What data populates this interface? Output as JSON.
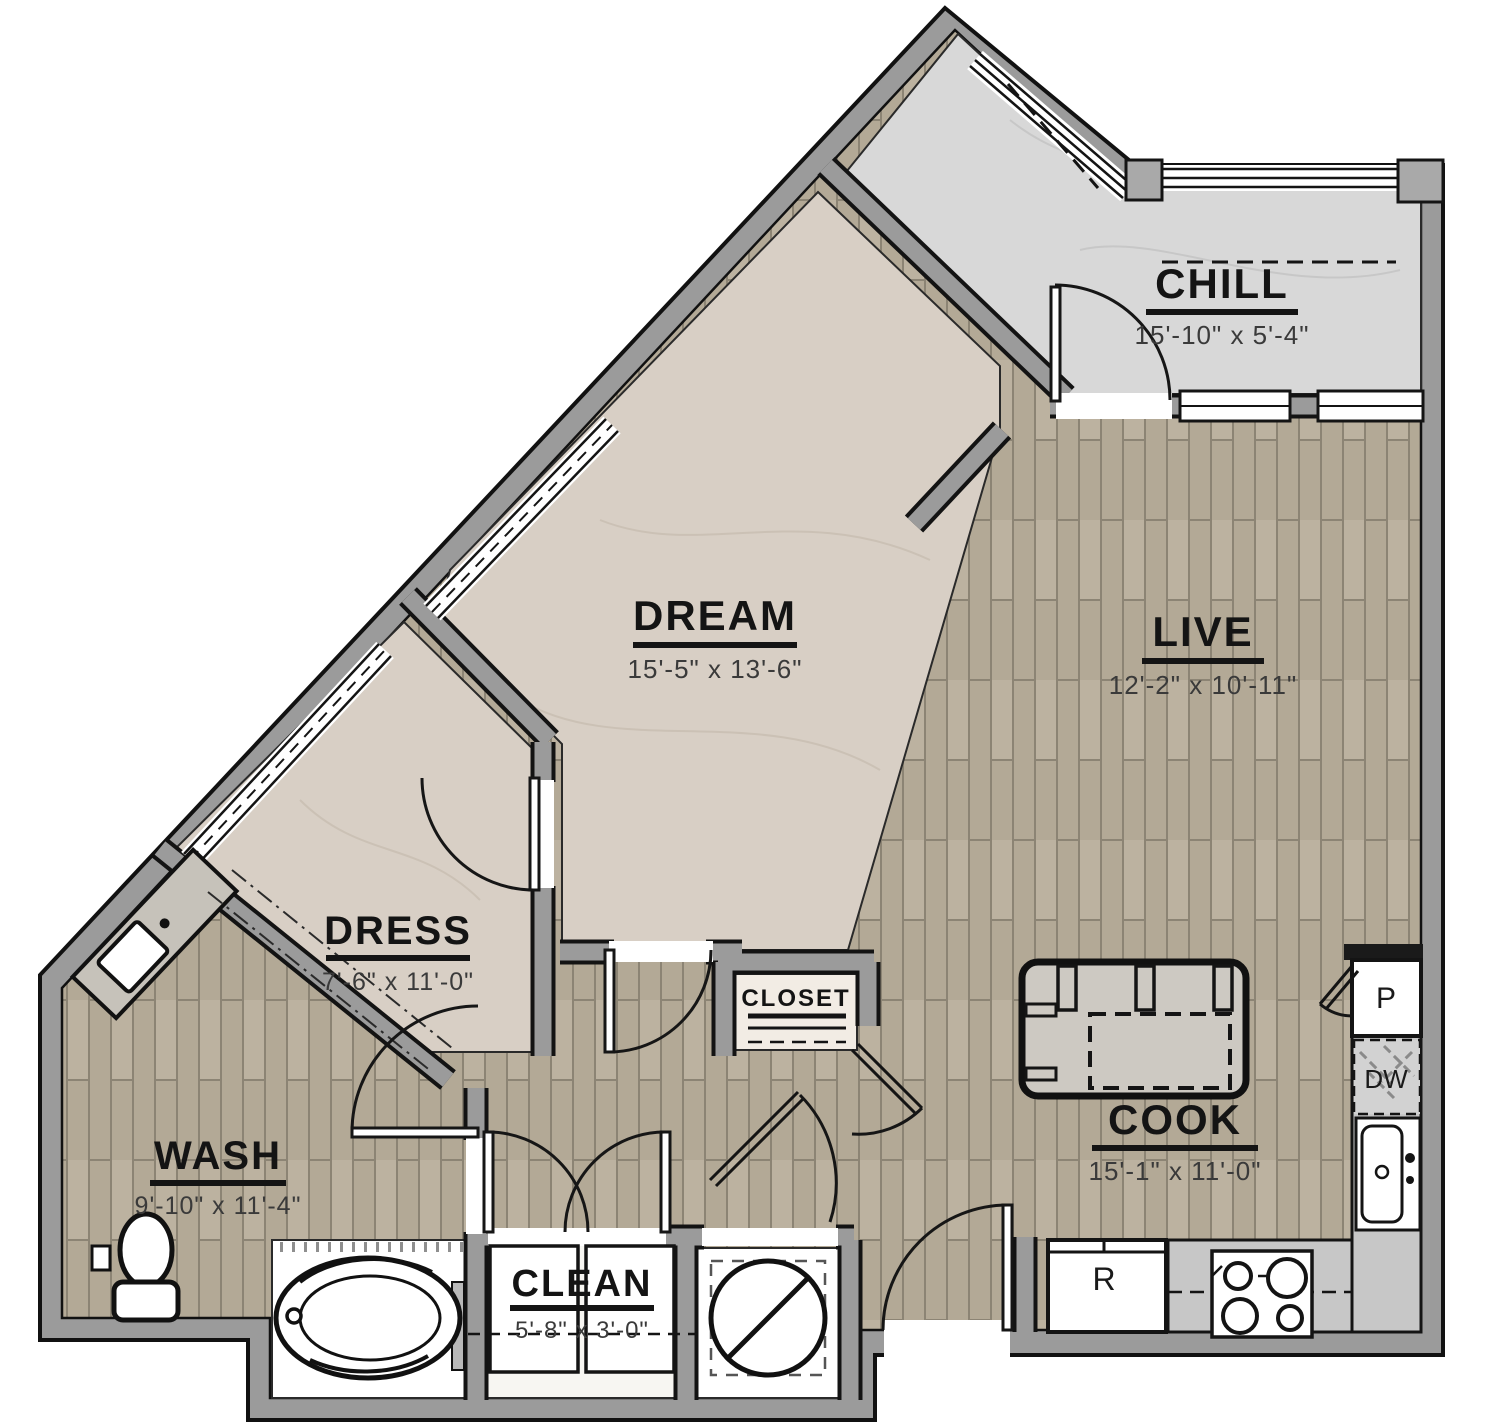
{
  "plan": {
    "type": "apartment-floor-plan",
    "rooms": [
      {
        "label": "CHILL",
        "dims": "15'-10\" x 5'-4\""
      },
      {
        "label": "DREAM",
        "dims": "15'-5\" x 13'-6\""
      },
      {
        "label": "LIVE",
        "dims": "12'-2\" x 10'-11\""
      },
      {
        "label": "DRESS",
        "dims": "7'-6\" x 11'-0\""
      },
      {
        "label": "WASH",
        "dims": "9'-10\" x 11'-4\""
      },
      {
        "label": "CLEAN",
        "dims": "5'-8\" x 3'-0\""
      },
      {
        "label": "COOK",
        "dims": "15'-1\" x 11'-0\""
      },
      {
        "label": "CLOSET",
        "dims": ""
      }
    ],
    "fixtures": {
      "pantry_label": "P",
      "dishwasher_label": "DW",
      "refrigerator_label": "R"
    },
    "colors": {
      "wall": "#9b9b9b",
      "wood_floor": "#b3a996",
      "carpet": "#d8cfc5",
      "concrete_patio": "#d8d8d8",
      "line": "#141414"
    }
  }
}
